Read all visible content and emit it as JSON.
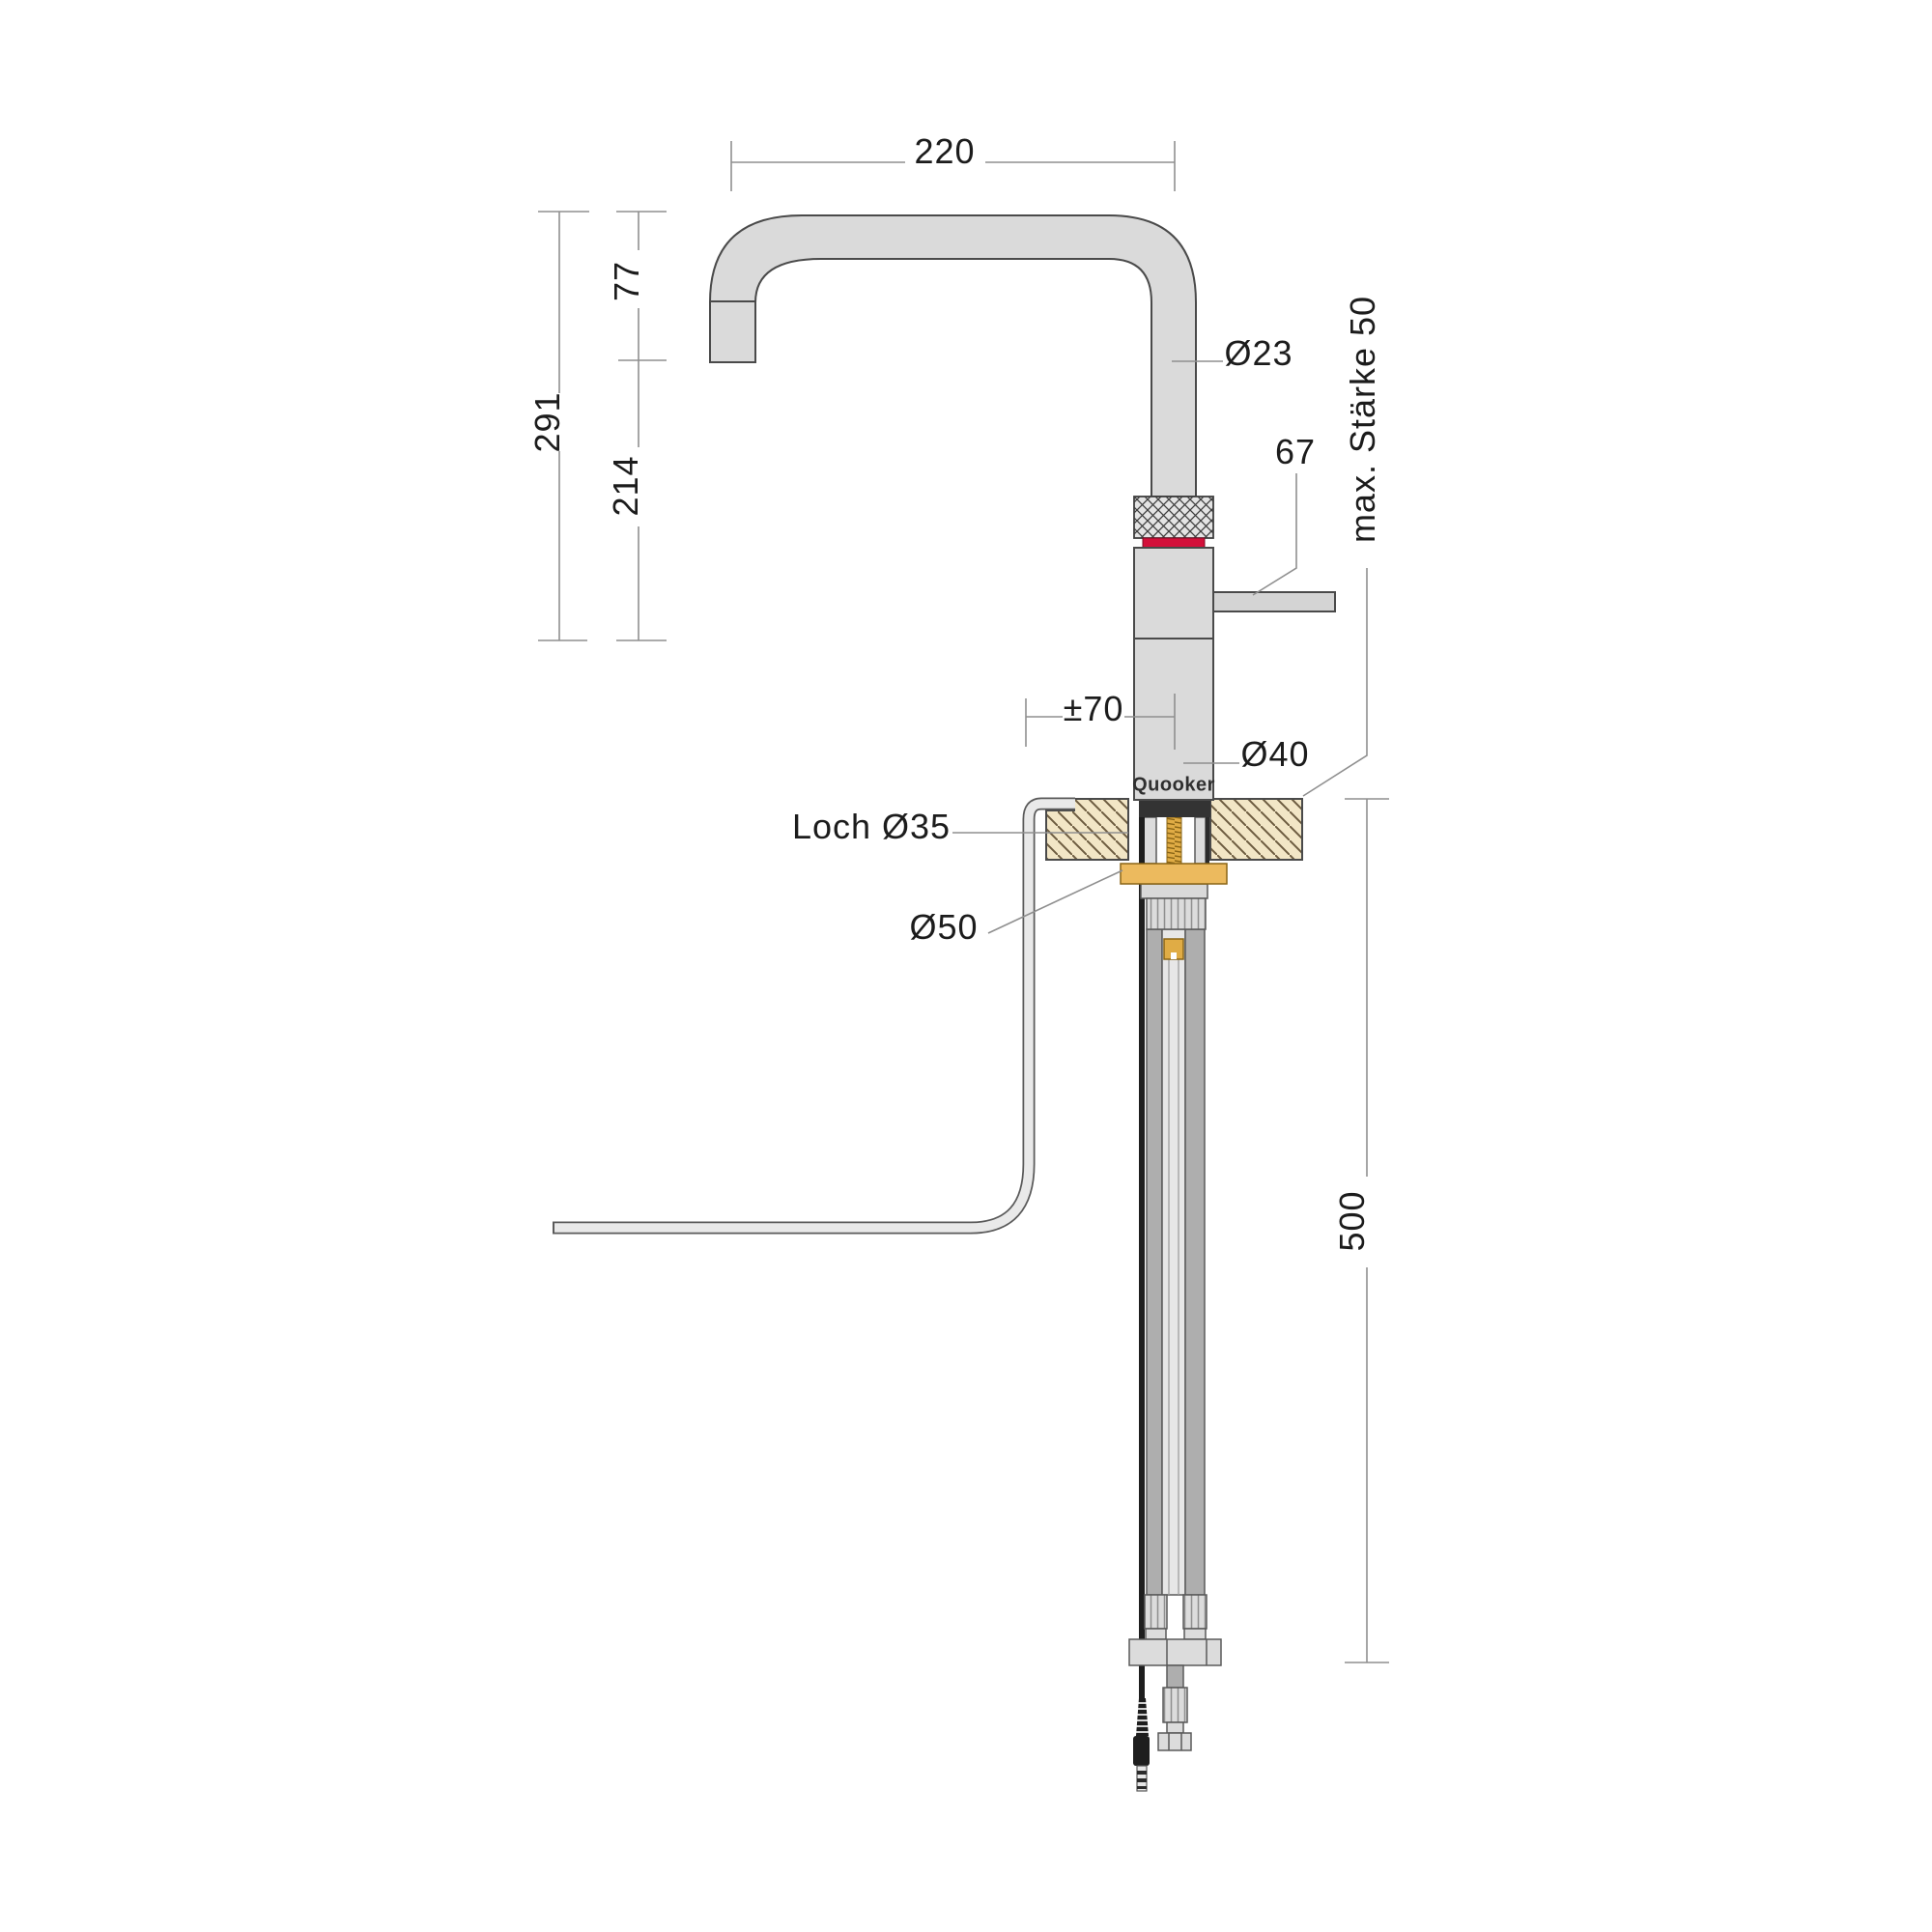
{
  "page": {
    "type": "technical-installation-drawing",
    "background": "#ffffff"
  },
  "product": {
    "brand": "Quooker"
  },
  "annotations": {
    "spout_reach": "220",
    "spout_drop": "77",
    "overall_height": "291",
    "body_height": "214",
    "spout_diameter": "Ø23",
    "handle_length": "67",
    "handle_offset": "±70",
    "body_diameter": "Ø40",
    "worktop_thickness": "max. Stärke 50",
    "hole_diameter": "Loch Ø35",
    "flange_diameter": "Ø50",
    "installation_depth": "500"
  },
  "colors": {
    "accent_red": "#D3103A",
    "brass": "#E9B95E",
    "worktop_beige": "#F2E6C6",
    "metal_gray": "#DADADA",
    "outline": "#4A4A4A",
    "dimension_line": "#8F8F8F"
  }
}
